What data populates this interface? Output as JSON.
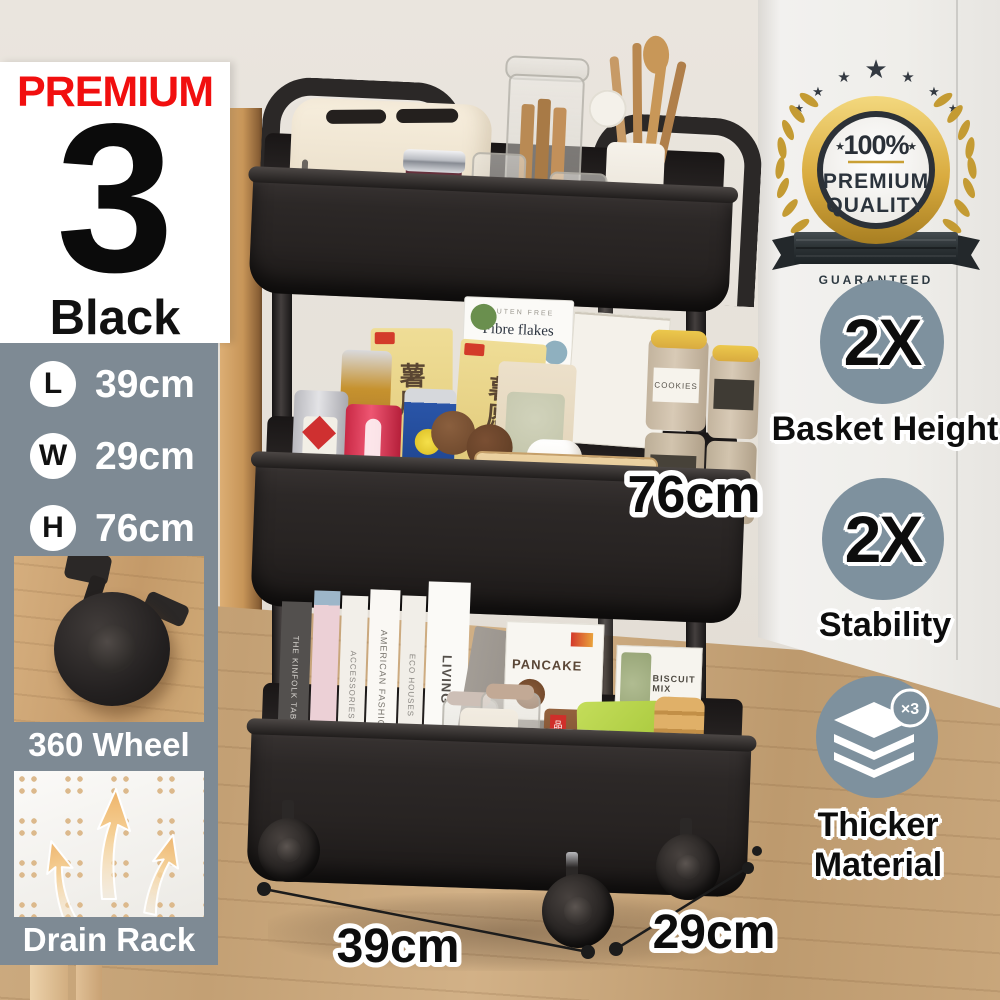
{
  "left_card": {
    "premium": "PREMIUM",
    "count": "3",
    "color": "Black"
  },
  "spec_panel": {
    "dims": [
      {
        "letter": "L",
        "value": "39cm"
      },
      {
        "letter": "W",
        "value": "29cm"
      },
      {
        "letter": "H",
        "value": "76cm"
      }
    ],
    "wheel_caption": "360 Wheel",
    "drain_caption": "Drain Rack"
  },
  "quality_badge": {
    "percent": "100%",
    "premium": "PREMIUM",
    "quality": "QUALITY",
    "guaranteed": "GUARANTEED"
  },
  "features": [
    {
      "value": "2X",
      "label": "Basket Height"
    },
    {
      "value": "2X",
      "label": "Stability"
    },
    {
      "value": "×3",
      "line1": "Thicker",
      "line2": "Material"
    }
  ],
  "annotations": {
    "height": "76cm",
    "length": "39cm",
    "depth": "29cm"
  },
  "products": {
    "gluten_free": "GLUTEN FREE",
    "fibre_flakes": "Fibre flakes",
    "chips_box": "薯愿",
    "cookies_tin": "COOKIES",
    "sugar_tin": "SUGAR",
    "biscuit_bag": "BISCUIT",
    "can_script": "Schw",
    "pancake_box": "PANCAKE",
    "biscuit_mix": "BISCUIT MIX",
    "smoothy": "smoothy",
    "brand_bag": "品牌名",
    "flapjack_1": "Apple",
    "flapjack_2": "& sultana",
    "flapjack_3": "flapjack",
    "books": [
      "THE KINFOLK TABLE",
      "ACCESSORIES",
      "AMERICAN FASHION",
      "ECO HOUSES",
      "LIVING"
    ]
  },
  "icons": {
    "star": "★"
  },
  "colors": {
    "accent_red": "#f10f0f",
    "panel_gray": "#7e8a94",
    "circle_gray": "#7e919e",
    "gold": "#d9ab3f",
    "cart_black": "#2b2726"
  }
}
